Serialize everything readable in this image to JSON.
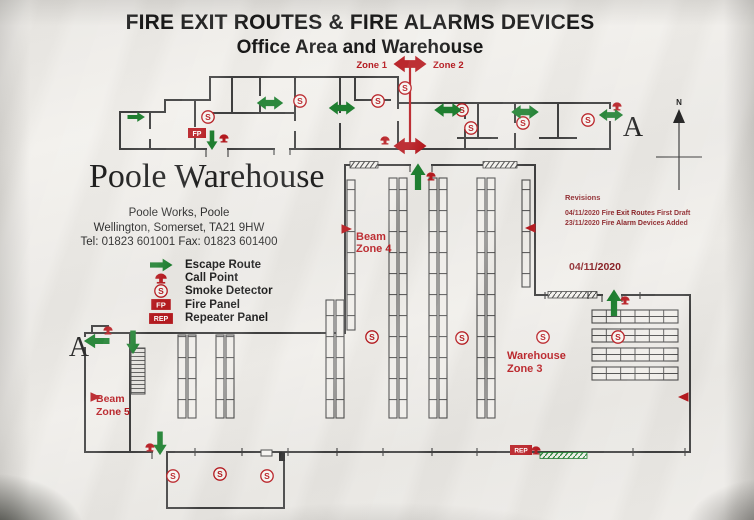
{
  "header": {
    "title": "FIRE EXIT ROUTES & FIRE ALARMS DEVICES",
    "subtitle": "Office Area and Warehouse"
  },
  "building": {
    "name": "Poole Warehouse",
    "address_line1": "Poole Works, Poole",
    "address_line2": "Wellington, Somerset, TA21 9HW",
    "address_line3": "Tel: 01823 601001 Fax: 01823 601400"
  },
  "legend": {
    "items": [
      {
        "icon": "escape-route-arrow-icon",
        "label": "Escape Route"
      },
      {
        "icon": "call-point-icon",
        "label": "Call Point"
      },
      {
        "icon": "smoke-detector-icon",
        "label": "Smoke Detector"
      },
      {
        "icon": "fire-panel-icon",
        "label": "Fire Panel"
      },
      {
        "icon": "repeater-panel-icon",
        "label": "Repeater Panel"
      }
    ]
  },
  "zones": {
    "zone1": "Zone 1",
    "zone2": "Zone 2",
    "beam_zone4_line1": "Beam",
    "beam_zone4_line2": "Zone 4",
    "warehouse_zone3_line1": "Warehouse",
    "warehouse_zone3_line2": "Zone 3",
    "beam_zone5_line1": "Beam",
    "beam_zone5_line2": "Zone 5"
  },
  "revisions": {
    "title": "Revisions",
    "entries": [
      "04/11/2020 Fire Exit Routes First Draft",
      "23/11/2020 Fire Alarm Devices Added"
    ],
    "date": "04/11/2020"
  },
  "compass": {
    "north_label": "N"
  },
  "section_markers": {
    "left": "A",
    "right": "A"
  },
  "panel_labels": {
    "fire_panel": "FP",
    "repeater_panel": "REP"
  },
  "colors": {
    "escape_green": "#1b7e2d",
    "alarm_red": "#b5161c",
    "revision_red": "#8a2025",
    "wall_gray": "#3d3d3d"
  },
  "plan": {
    "smoke_symbol": "S",
    "smoke_detectors": [
      {
        "x": 208,
        "y": 117
      },
      {
        "x": 300,
        "y": 101
      },
      {
        "x": 378,
        "y": 101
      },
      {
        "x": 405,
        "y": 88
      },
      {
        "x": 462,
        "y": 110
      },
      {
        "x": 471,
        "y": 128
      },
      {
        "x": 523,
        "y": 123
      },
      {
        "x": 588,
        "y": 120
      },
      {
        "x": 372,
        "y": 337
      },
      {
        "x": 462,
        "y": 338
      },
      {
        "x": 543,
        "y": 337
      },
      {
        "x": 618,
        "y": 337
      },
      {
        "x": 173,
        "y": 476
      },
      {
        "x": 220,
        "y": 474
      },
      {
        "x": 267,
        "y": 476
      }
    ],
    "call_points": [
      {
        "x": 224,
        "y": 138
      },
      {
        "x": 385,
        "y": 140
      },
      {
        "x": 617,
        "y": 106
      },
      {
        "x": 431,
        "y": 176
      },
      {
        "x": 108,
        "y": 330
      },
      {
        "x": 150,
        "y": 447
      },
      {
        "x": 625,
        "y": 300
      },
      {
        "x": 536,
        "y": 450
      }
    ],
    "escape_arrows": [
      {
        "x": 136,
        "y": 117,
        "dir": "right",
        "style": "single",
        "s": 0.85
      },
      {
        "x": 212,
        "y": 140,
        "dir": "down",
        "style": "single",
        "s": 0.95
      },
      {
        "x": 270,
        "y": 103,
        "dir": "h",
        "style": "double",
        "s": 1.2
      },
      {
        "x": 342,
        "y": 108,
        "dir": "h",
        "style": "double",
        "s": 1.2
      },
      {
        "x": 448,
        "y": 110,
        "dir": "h",
        "style": "double",
        "s": 1.25
      },
      {
        "x": 525,
        "y": 112,
        "dir": "h",
        "style": "double",
        "s": 1.25
      },
      {
        "x": 611,
        "y": 115,
        "dir": "h",
        "style": "double",
        "s": 1.1
      },
      {
        "x": 418,
        "y": 177,
        "dir": "up",
        "style": "single",
        "s": 1.3
      },
      {
        "x": 97,
        "y": 341,
        "dir": "left",
        "style": "single",
        "s": 1.25
      },
      {
        "x": 133,
        "y": 342,
        "dir": "down",
        "style": "single",
        "s": 1.15
      },
      {
        "x": 160,
        "y": 443,
        "dir": "down",
        "style": "single",
        "s": 1.15
      },
      {
        "x": 614,
        "y": 303,
        "dir": "up",
        "style": "single",
        "s": 1.3
      }
    ],
    "beam_detectors": [
      {
        "x": 346,
        "y": 229,
        "dir": "left"
      },
      {
        "x": 531,
        "y": 228,
        "dir": "right"
      },
      {
        "x": 95,
        "y": 397,
        "dir": "left"
      },
      {
        "x": 684,
        "y": 397,
        "dir": "right"
      }
    ],
    "fire_panels": [
      {
        "x": 197,
        "y": 133
      }
    ],
    "repeater_panels": [
      {
        "x": 521,
        "y": 450
      }
    ]
  }
}
